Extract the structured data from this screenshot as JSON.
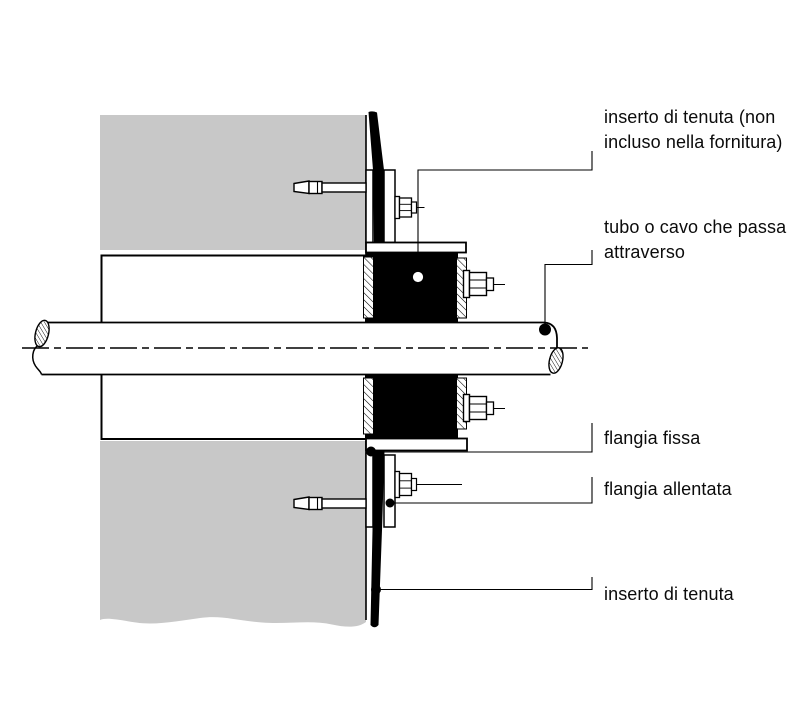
{
  "figure": {
    "background_color": "#ffffff",
    "wall_color": "#c8c8c8",
    "line_color": "#000000",
    "seal_color": "#000000",
    "labels": [
      {
        "id": "seal-insert-not-included",
        "lines": [
          "inserto di tenuta (non",
          "incluso nella fornitura)"
        ]
      },
      {
        "id": "pipe-or-cable",
        "lines": [
          "tubo o cavo che passa",
          "attraverso"
        ]
      },
      {
        "id": "fixed-flange",
        "lines": [
          "flangia fissa"
        ]
      },
      {
        "id": "loose-flange",
        "lines": [
          "flangia allentata"
        ]
      },
      {
        "id": "seal-insert",
        "lines": [
          "inserto di tenuta"
        ]
      }
    ]
  }
}
